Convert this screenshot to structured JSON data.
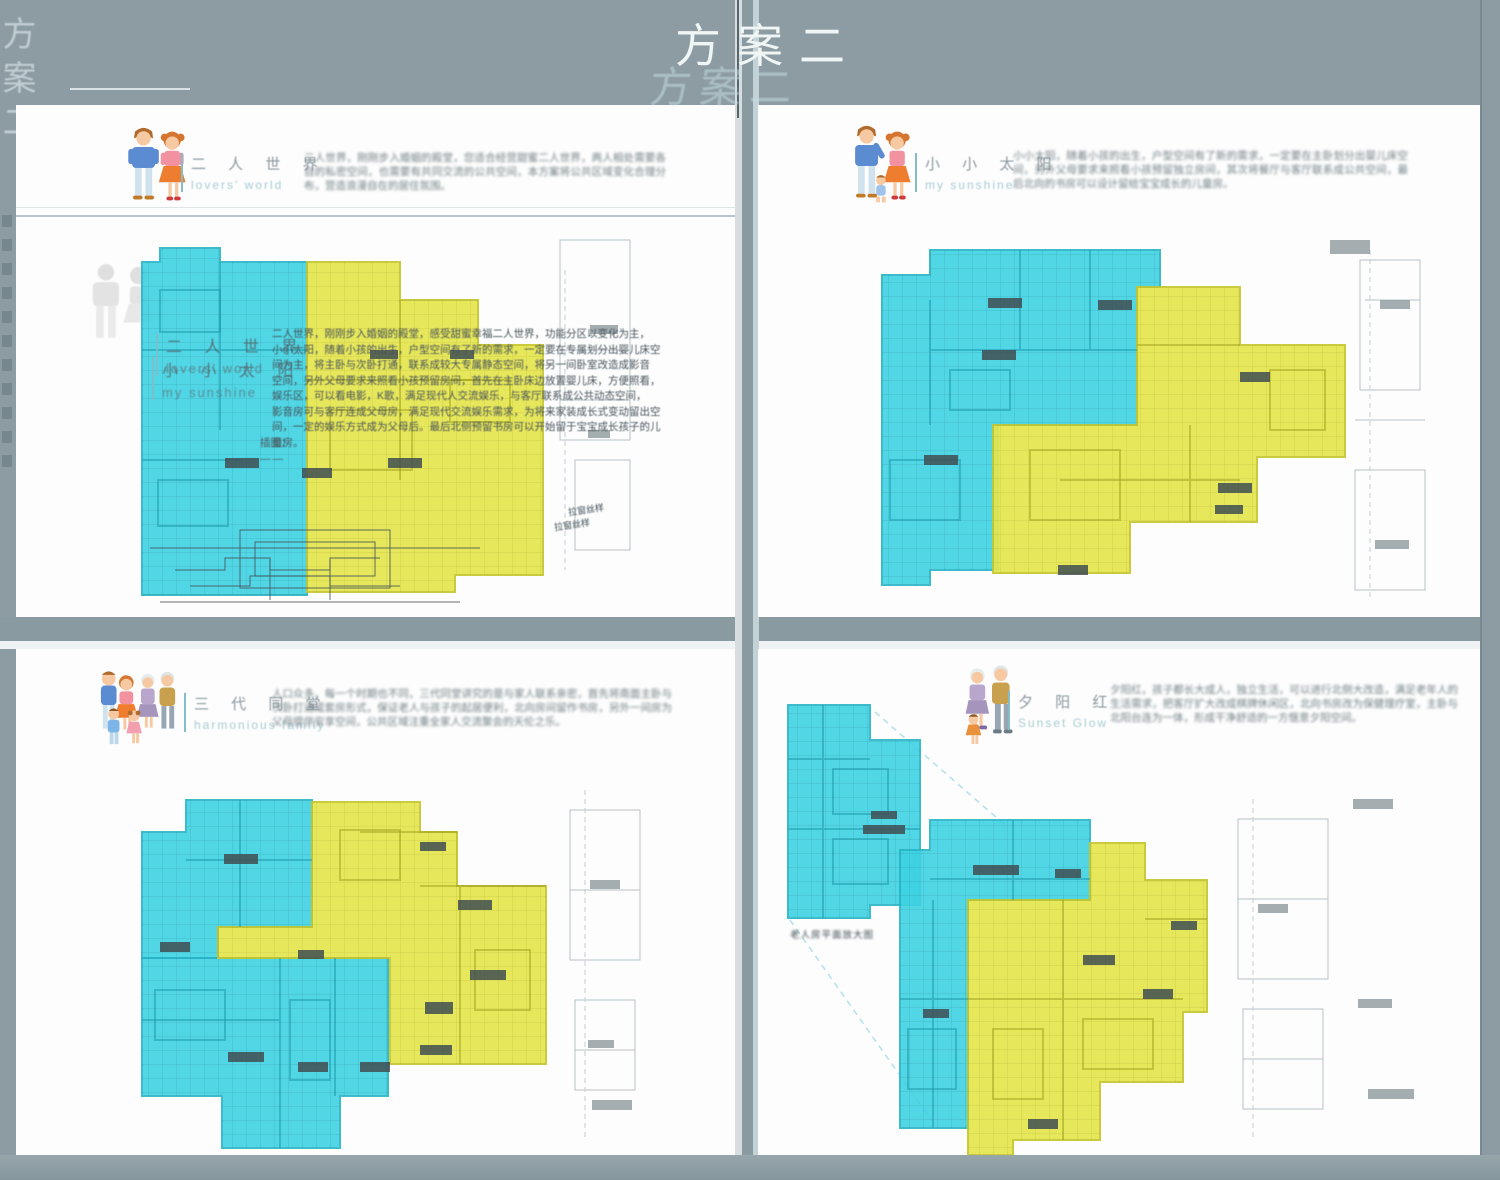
{
  "doc": {
    "main_title": "方案二",
    "ghost_title": "方案二",
    "side_title": "方案二",
    "window_note": "拉窗丝样",
    "window_note2": "拉窗丝样"
  },
  "panels": [
    {
      "key": "lovers",
      "title_cn": "二 人 世 界",
      "title_en": "lovers'  world",
      "para": "二人世界，刚刚步入婚姻的殿堂，您适合经营甜蜜二人世界，两人相处需要各自的私密空间，也需要有共同交流的公共空间，本方案将公共区域变化合理分布，营造浪漫自在的居住氛围。",
      "overlay_title1_cn": "二 人 世 界",
      "overlay_title1_en": "lovers'  world",
      "overlay_title2_cn": "小 小 太 阳",
      "overlay_title2_en": "my  sunshine",
      "overlay_text": "二人世界，刚刚步入婚姻的殿堂，感受甜蜜幸福二人世界，功能分区以变化为主，\n小小太阳，随着小孩的出生，户型空间有了新的需求，一定要在专属划分出婴儿床空\n间为主，将主卧与次卧打通，联系成较大专属静态空间，将另一间卧室改造成影音\n空间，另外父母要求来照看小孩预留房间，首先在主卧床边放置婴儿床，方便照看，\n娱乐区，可以看电影，K歌，满足现代人交流娱乐，与客厅联系成公共动态空间，\n影音房可与客厅连成父母房，满足现代交流娱乐需求，为将来家装成长式变动留出空\n间，一定的娱乐方式成为父母后。最后北侧预留书房可以开始留于宝宝成长孩子的儿\n童房。",
      "annot_label": "插图：",
      "annot_dash": "——"
    },
    {
      "key": "sunshine",
      "title_cn": "小 小 太 阳",
      "title_en": "my  sunshine",
      "para": "小小太阳，随着小孩的出生，户型空间有了新的需求，一定要在主卧划分出婴儿床空间，另外父母要求来照看小孩预留独立房间，其次将餐厅与客厅联系成公共空间，最后北向的书房可以设计留给宝宝成长的儿童房。"
    },
    {
      "key": "family",
      "title_cn": "三 代 同 堂",
      "title_en": "harmonious  family",
      "para": "人口众多，每一个时期也不同，三代同堂讲究的是与家人联系亲密，首先将南面主卧与次卧打通成套房形式，保证老人与孩子的起居便利，北向房间留作书房，另外一间房为父母提供安享空间，公共区域注重全家人交流聚会的天伦之乐。"
    },
    {
      "key": "sunset",
      "title_cn": "夕 阳 红",
      "title_en": "Sunset  Glow",
      "para": "夕阳红，孩子都长大成人，独立生活，可以进行北侧大改造，满足老年人的生活需求，把客厅扩大改成棋牌休闲区，北向书房改为保健理疗室，主卧与北阳台连为一体，形成干净舒适的一方惬意夕阳空间。",
      "caption": "老人房平面放大图"
    }
  ]
}
